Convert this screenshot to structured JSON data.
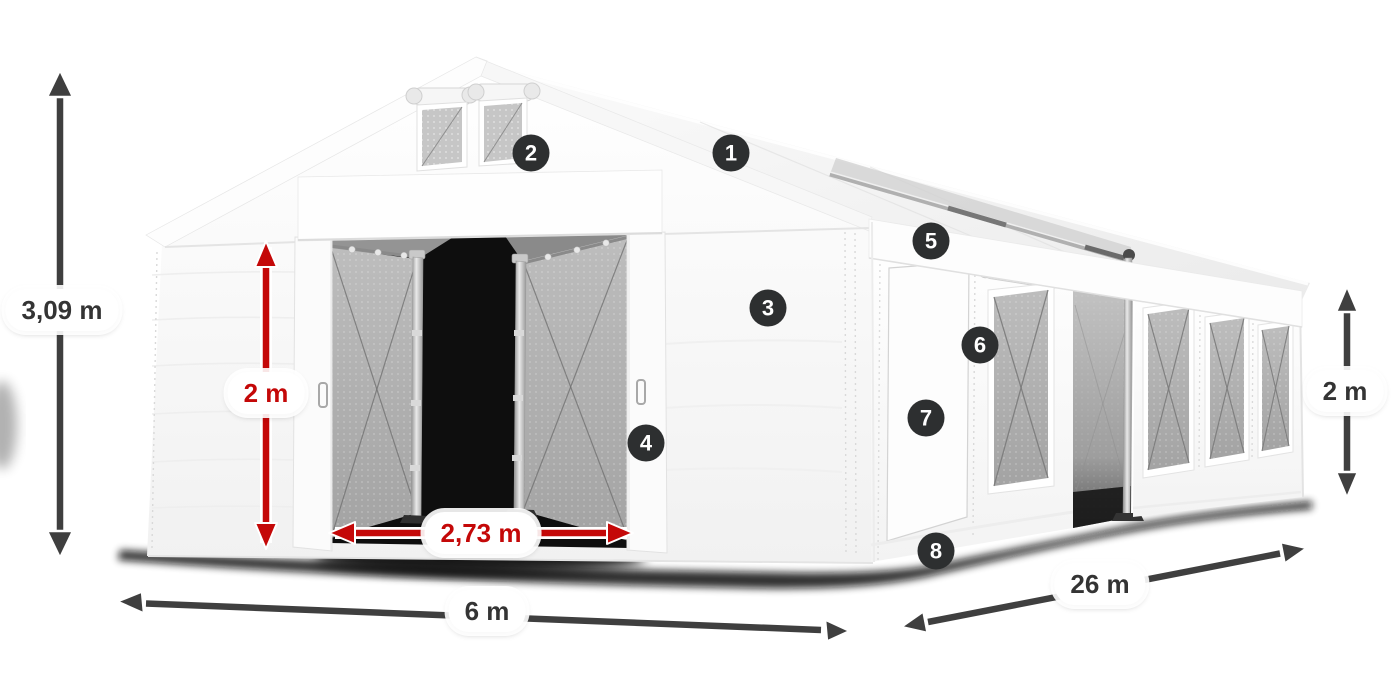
{
  "product_diagram": {
    "description": "White marquee tent illustration with numbered part callouts and dimension arrows",
    "dimension_labels": [
      {
        "id": "total_height",
        "text": "3,09 m",
        "style": "dark",
        "orientation": "vertical"
      },
      {
        "id": "entrance_height",
        "text": "2 m",
        "style": "red",
        "orientation": "vertical"
      },
      {
        "id": "entrance_width",
        "text": "2,73 m",
        "style": "red",
        "orientation": "horizontal"
      },
      {
        "id": "front_width",
        "text": "6 m",
        "style": "dark",
        "orientation": "horizontal"
      },
      {
        "id": "side_length",
        "text": "26 m",
        "style": "dark",
        "orientation": "diagonal"
      },
      {
        "id": "side_height",
        "text": "2 m",
        "style": "dark",
        "orientation": "vertical"
      }
    ],
    "callout_numbers": [
      "1",
      "2",
      "3",
      "4",
      "5",
      "6",
      "7",
      "8"
    ],
    "colors": {
      "dimension_red": "#c40808",
      "dimension_dark": "#3f3f3f",
      "badge_background": "#2d2f30",
      "badge_text": "#ffffff",
      "tent_white": "#fcfcfc",
      "mesh_gray": "#b2b2b2"
    }
  }
}
